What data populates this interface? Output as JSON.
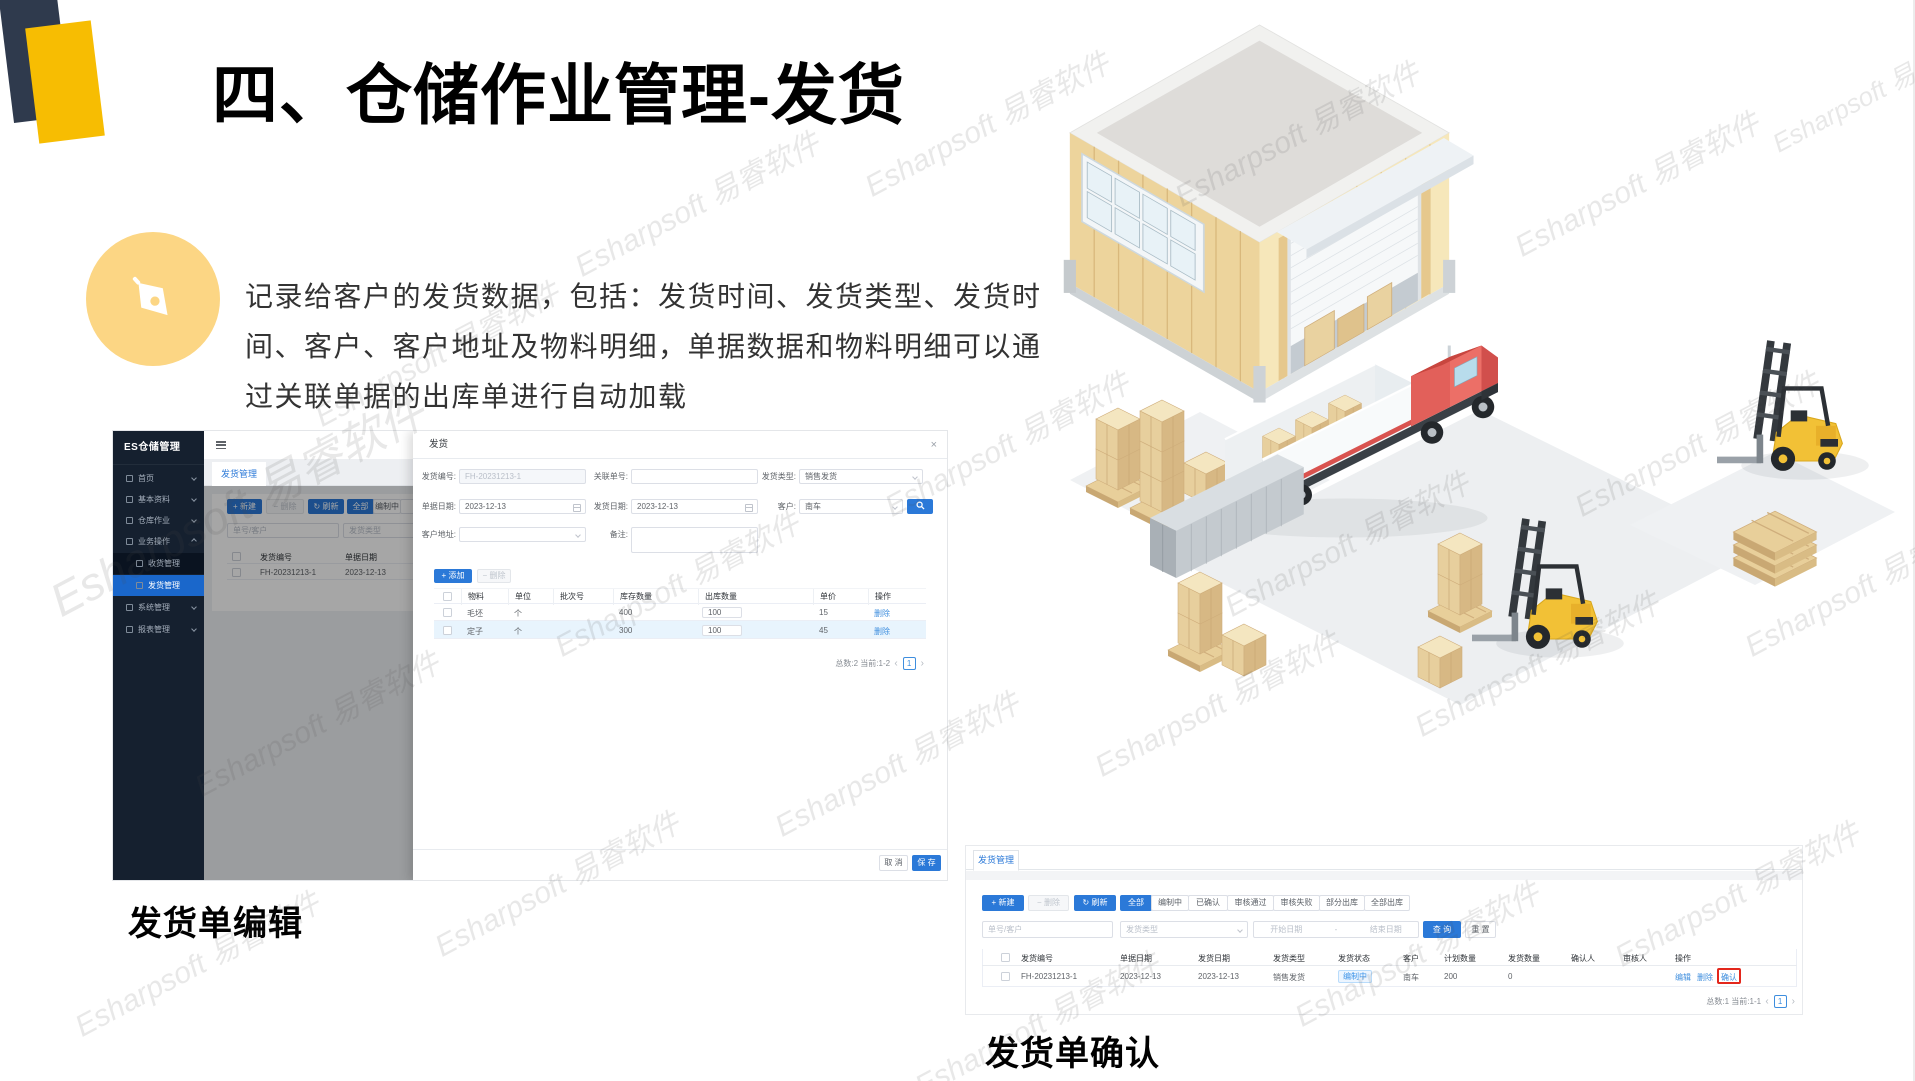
{
  "watermark": "Esharpsoft 易睿软件",
  "slide": {
    "title": "四、仓储作业管理-发货",
    "desc_line1": "记录给客户的发货数据，包括：发货时间、发货类型、发货时",
    "desc_line2": "间、客户、客户地址及物料明细，单据数据和物料明细可以通",
    "desc_line3": "过关联单据的出库单进行自动加载",
    "caption_edit": "发货单编辑",
    "caption_confirm": "发货单确认"
  },
  "icons": {
    "plus": "+",
    "minus": "−",
    "refresh": "↻",
    "close": "×",
    "prev": "‹",
    "next": "›"
  },
  "edit_screen": {
    "sidebar": {
      "title": "ES仓储管理",
      "items": [
        {
          "label": "首页"
        },
        {
          "label": "基本资料"
        },
        {
          "label": "仓库作业"
        },
        {
          "label": "业务操作"
        },
        {
          "label": "收货管理"
        },
        {
          "label": "发货管理"
        },
        {
          "label": "系统管理"
        },
        {
          "label": "报表管理"
        }
      ]
    },
    "tab": "发货管理",
    "btn_new": "新建",
    "btn_delete": "删除",
    "btn_refresh": "刷新",
    "filter_all": "全部",
    "filter_drafting": "编制中",
    "search_placeholder": "单号/客户",
    "type_placeholder": "发货类型",
    "table": {
      "col_code": "发货编号",
      "col_date": "单据日期",
      "row_code": "FH-20231213-1",
      "row_date": "2023-12-13"
    },
    "dialog": {
      "title": "发货",
      "label_code": "发货编号:",
      "value_code": "FH-20231213-1",
      "label_ref": "关联单号:",
      "label_type": "发货类型:",
      "value_type": "销售发货",
      "label_doc_date": "单据日期:",
      "value_doc_date": "2023-12-13",
      "label_ship_date": "发货日期:",
      "value_ship_date": "2023-12-13",
      "label_customer": "客户:",
      "value_customer": "南车",
      "label_address": "客户地址:",
      "label_remark": "备注:",
      "btn_add": "添加",
      "btn_remove": "删除",
      "cols": {
        "material": "物料",
        "unit": "单位",
        "batch": "批次号",
        "stock": "库存数量",
        "out": "出库数量",
        "price": "单价",
        "action": "操作"
      },
      "rows": [
        {
          "material": "毛坯",
          "unit": "个",
          "batch": "",
          "stock": "400",
          "out": "100",
          "price": "15",
          "action": "删除"
        },
        {
          "material": "定子",
          "unit": "个",
          "batch": "",
          "stock": "300",
          "out": "100",
          "price": "45",
          "action": "删除"
        }
      ],
      "pagination": "总数:2 当前:1-2",
      "page": "1",
      "btn_cancel": "取 消",
      "btn_save": "保 存"
    }
  },
  "confirm_screen": {
    "tab": "发货管理",
    "btn_new": "新建",
    "btn_delete": "删除",
    "btn_refresh": "刷新",
    "filters": [
      "全部",
      "编制中",
      "已确认",
      "审核通过",
      "审核失败",
      "部分出库",
      "全部出库"
    ],
    "search_placeholder": "单号/客户",
    "type_placeholder": "发货类型",
    "date_start": "开始日期",
    "date_sep": "-",
    "date_end": "结束日期",
    "btn_query": "查 询",
    "btn_reset": "重 置",
    "cols": [
      "发货编号",
      "单据日期",
      "发货日期",
      "发货类型",
      "发货状态",
      "客户",
      "计划数量",
      "发货数量",
      "确认人",
      "审核人",
      "操作"
    ],
    "row": {
      "code": "FH-20231213-1",
      "doc_date": "2023-12-13",
      "ship_date": "2023-12-13",
      "type": "销售发货",
      "status": "编制中",
      "customer": "南车",
      "plan": "200",
      "shipped": "0",
      "confirmer": "",
      "auditor": "",
      "action_edit": "编辑",
      "action_delete": "删除",
      "action_confirm": "确认"
    },
    "pagination": "总数:1 当前:1-1",
    "page": "1"
  }
}
